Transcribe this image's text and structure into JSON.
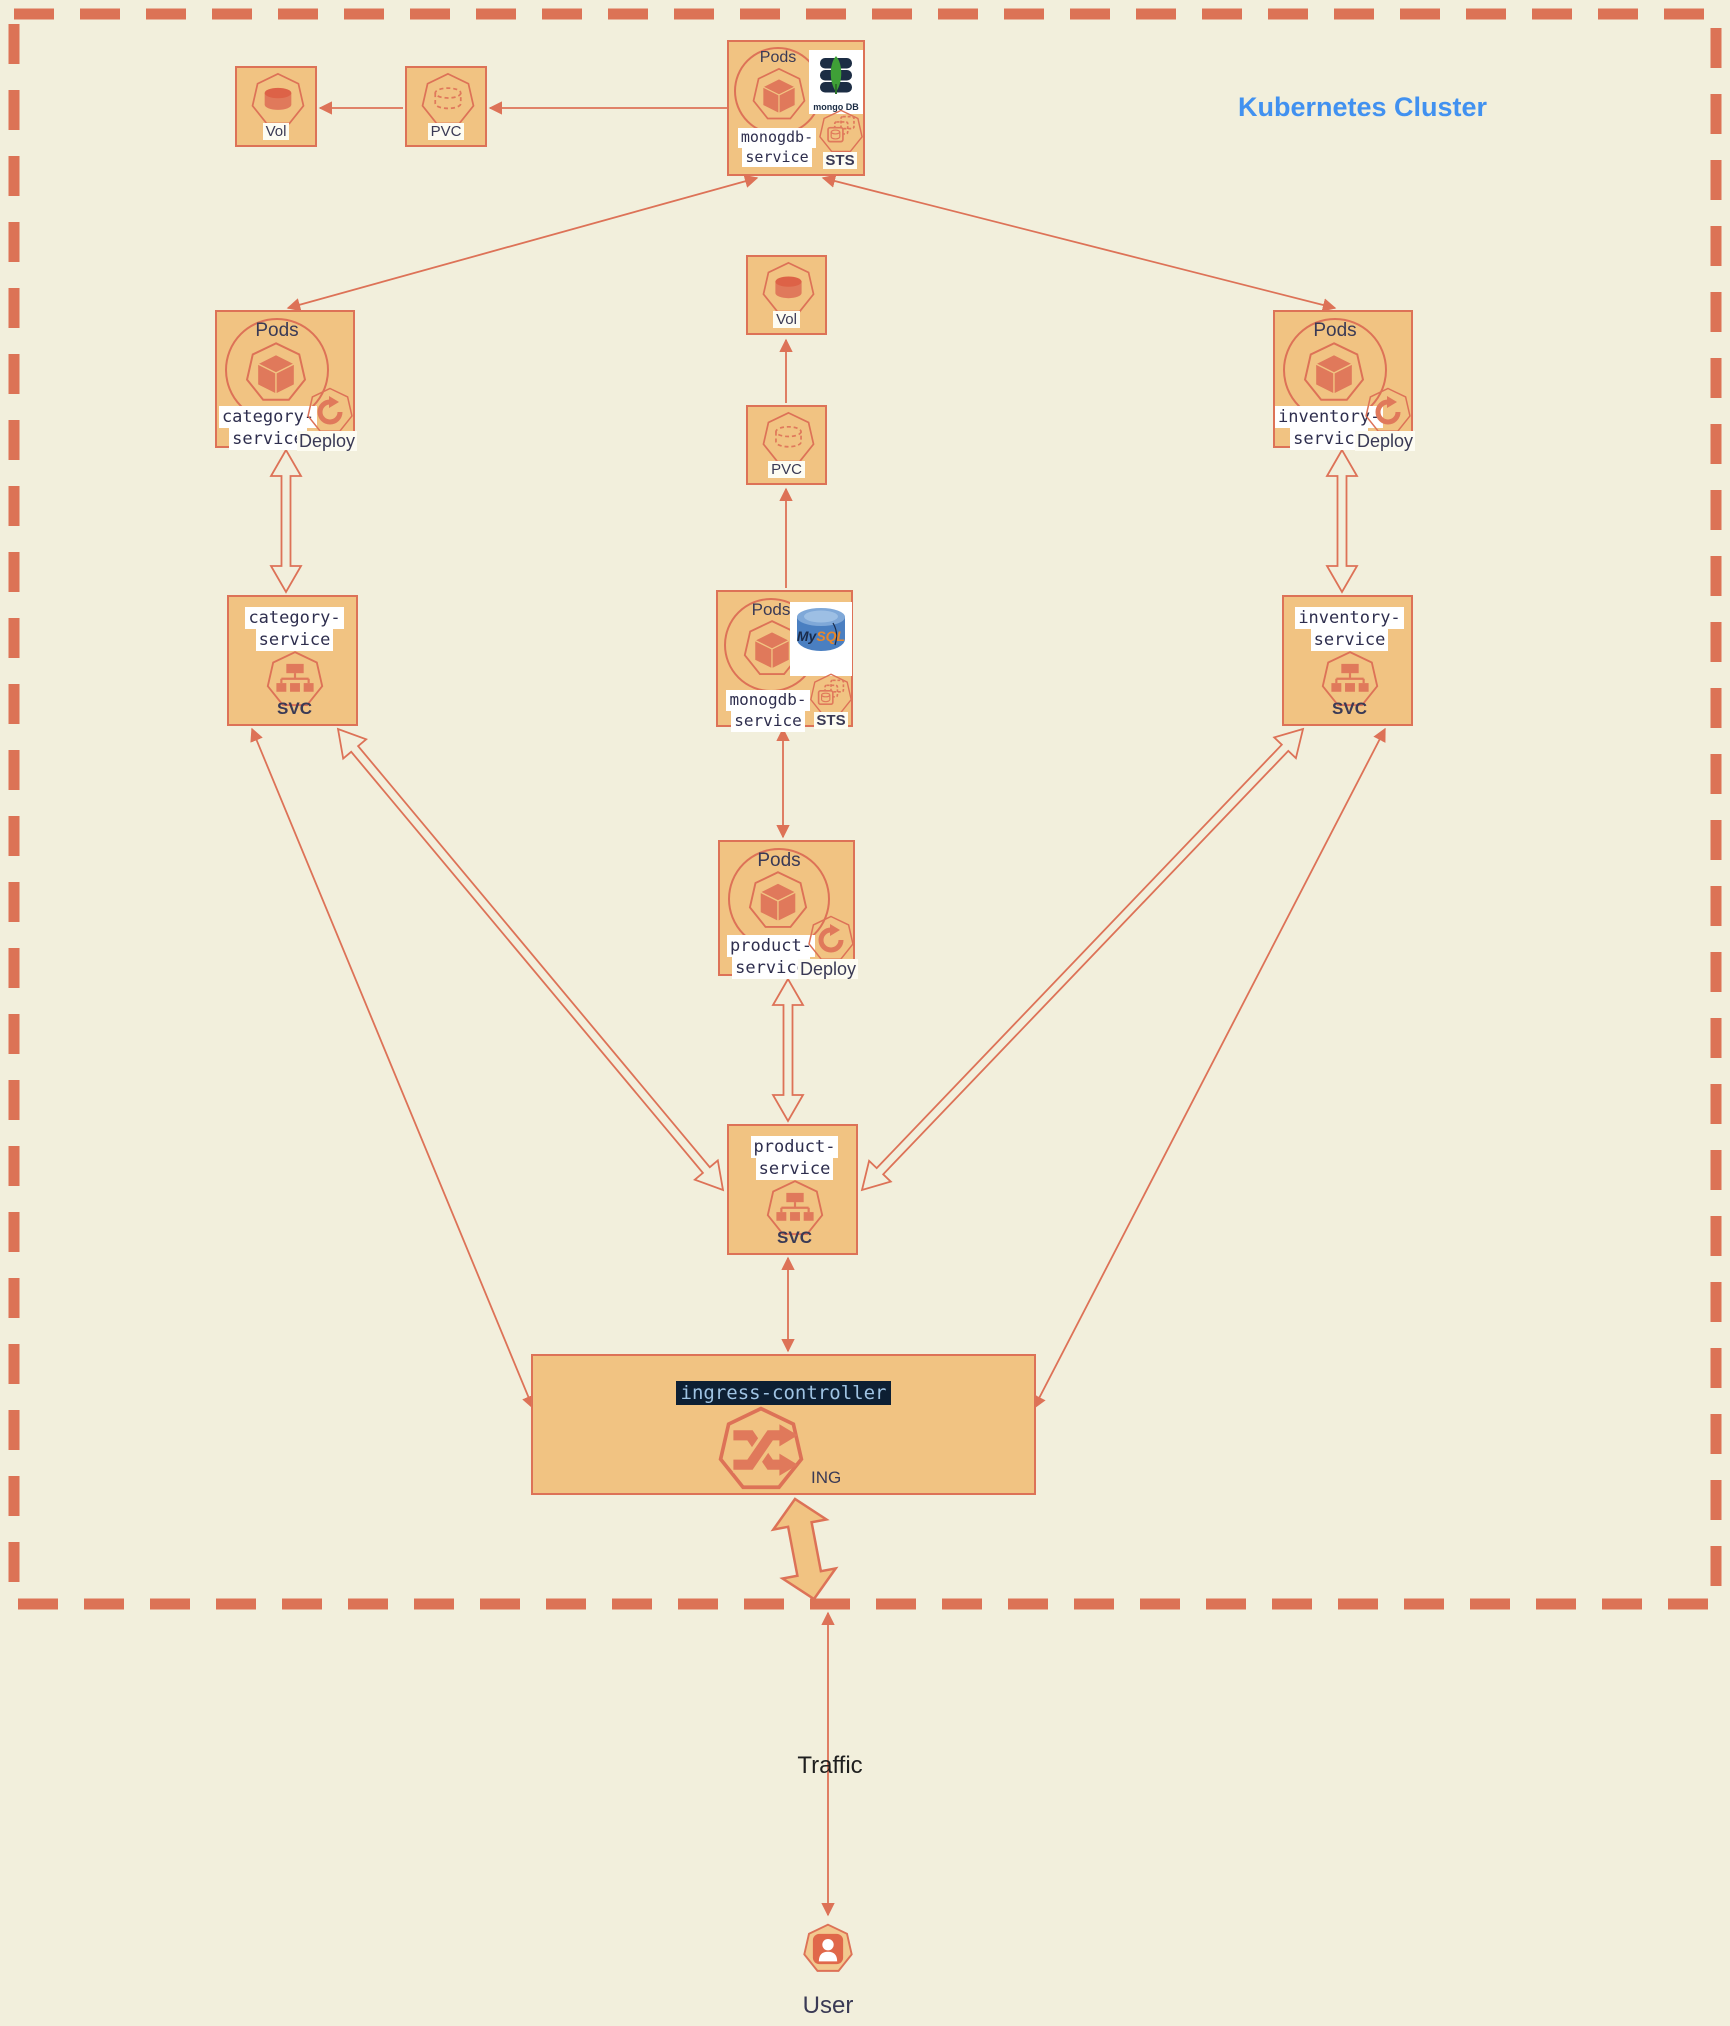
{
  "cluster": {
    "title": "Kubernetes Cluster",
    "border_color": "#dc7356",
    "background": "#f2efdc"
  },
  "colors": {
    "box_fill": "#f1c382",
    "box_border": "#dd7257",
    "icon_salmon": "#e0795b",
    "label_dark": "#3a3a55",
    "service_name_text": "#2e2e4e",
    "title_blue": "#4191f0",
    "ingress_label_bg": "#0d1f33",
    "ingress_label_text": "#9fc3e3",
    "mongo_navy": "#1c2d44",
    "mongo_green": "#3fa037",
    "mysql_blue": "#4a7fc1",
    "mysql_orange": "#e8872a"
  },
  "nodes": {
    "mongodb_statefulset": {
      "pods_label": "Pods",
      "name_line1": "monogdb-",
      "name_line2": "service",
      "type_label": "STS",
      "logo_text": "mongo DB",
      "icon": "mongodb-logo"
    },
    "vol_top": {
      "label": "Vol",
      "icon": "volume-icon"
    },
    "pvc_top": {
      "label": "PVC",
      "icon": "pvc-icon"
    },
    "vol_mid": {
      "label": "Vol",
      "icon": "volume-icon"
    },
    "pvc_mid": {
      "label": "PVC",
      "icon": "pvc-icon"
    },
    "category_pods": {
      "pods_label": "Pods",
      "name_line1": "category-",
      "name_line2": "service",
      "deploy_label": "Deploy"
    },
    "inventory_pods": {
      "pods_label": "Pods",
      "name_line1": "inventory-",
      "name_line2": "service",
      "deploy_label": "Deploy"
    },
    "mysql_statefulset": {
      "pods_label": "Pods",
      "name_line1": "monogdb-",
      "name_line2": "service",
      "type_label": "STS",
      "logo_my": "My",
      "logo_sql": "SQL",
      "icon": "mysql-logo"
    },
    "category_svc": {
      "name_line1": "category-",
      "name_line2": "service",
      "type_label": "SVC"
    },
    "inventory_svc": {
      "name_line1": "inventory-",
      "name_line2": "service",
      "type_label": "SVC"
    },
    "product_pods": {
      "pods_label": "Pods",
      "name_line1": "product-",
      "name_line2": "service",
      "deploy_label": "Deploy"
    },
    "product_svc": {
      "name_line1": "product-",
      "name_line2": "service",
      "type_label": "SVC"
    },
    "ingress": {
      "name": "ingress-controller",
      "type_label": "ING"
    },
    "traffic_label": "Traffic",
    "user": {
      "label": "User"
    }
  }
}
